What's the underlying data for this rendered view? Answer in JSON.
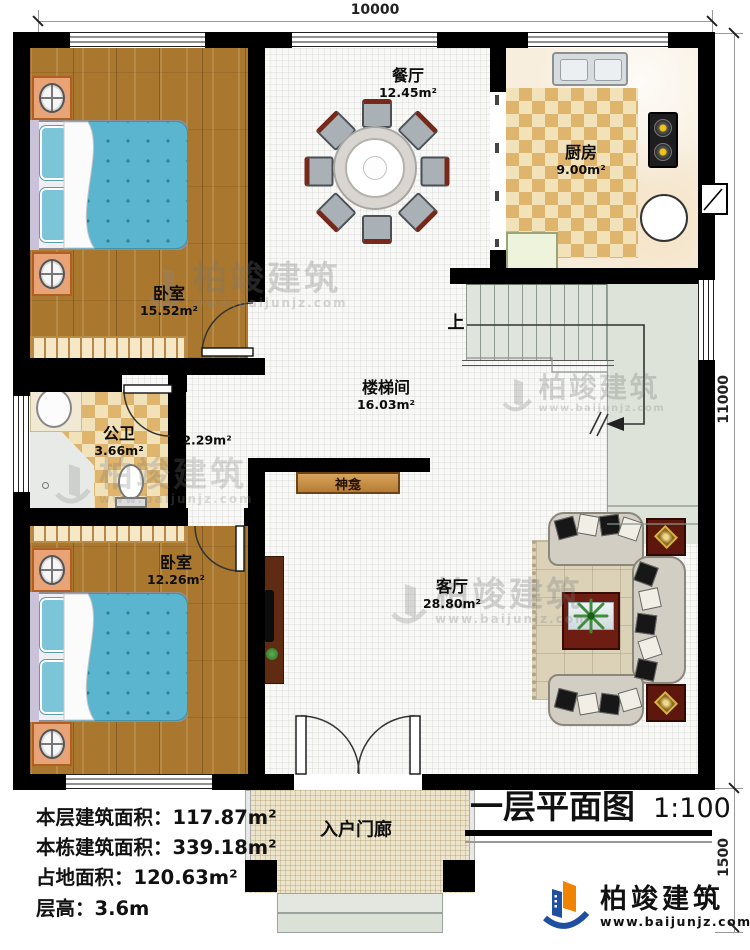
{
  "dimensions": {
    "top": "10000",
    "right": "11000",
    "right_lower": "1500"
  },
  "rooms": {
    "bedroom_top": {
      "name": "卧室",
      "area": "15.52m²"
    },
    "dining": {
      "name": "餐厅",
      "area": "12.45m²"
    },
    "kitchen": {
      "name": "厨房",
      "area": "9.00m²"
    },
    "stairwell": {
      "name": "楼梯间",
      "area": "16.03m²"
    },
    "bathroom": {
      "name": "公卫",
      "area": "3.66m²"
    },
    "hallway": {
      "area": "2.29m²"
    },
    "bedroom_bottom": {
      "name": "卧室",
      "area": "12.26m²"
    },
    "living": {
      "name": "客厅",
      "area": "28.80m²"
    },
    "porch": {
      "name": "入户门廊"
    },
    "shrine": {
      "name": "神龛"
    }
  },
  "stair": {
    "up_label": "上"
  },
  "stats": [
    {
      "label": "本层建筑面积：",
      "value": "117.87m²"
    },
    {
      "label": "本栋建筑面积：",
      "value": "339.18m²"
    },
    {
      "label": "占地面积：",
      "value": "120.63m²"
    },
    {
      "label": "层高：",
      "value": "3.6m"
    }
  ],
  "title": {
    "text": "一层平面图",
    "scale": "1:100"
  },
  "brand": {
    "name": "柏竣建筑",
    "url": "www.baijunjz.com"
  },
  "watermark": {
    "name": "柏竣建筑",
    "url": "www.baijunjz.com"
  },
  "colors": {
    "accent_blue": "#1e4fa1",
    "accent_orange": "#f08300",
    "wall": "#000000"
  }
}
